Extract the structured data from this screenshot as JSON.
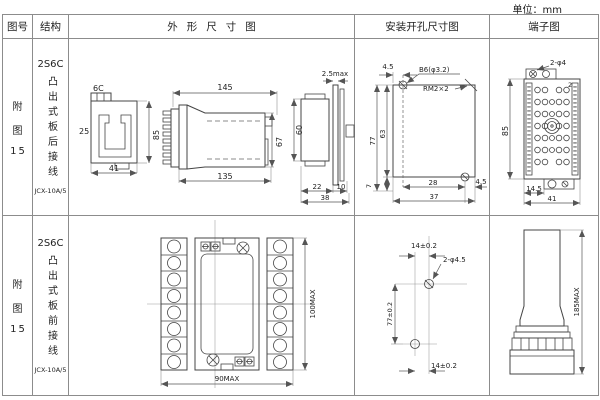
{
  "unit_label": "单位：mm",
  "colors": {
    "line": "#444444",
    "grid": "#8c8c8c",
    "text": "#222222",
    "background": "#ffffff"
  },
  "table": {
    "headers": {
      "fig_no": "图号",
      "structure": "结构",
      "outline": "外形尺寸图",
      "mounting": "安装开孔尺寸图",
      "terminal": "端子图"
    },
    "rows": [
      {
        "fig_no": {
          "l1": "附",
          "l2": "图",
          "l3": "15"
        },
        "structure": {
          "model": "2S6C",
          "desc": "凸出式板后接线",
          "type": "JCX-10A/5"
        },
        "outline": {
          "profile": {
            "top": "6C",
            "left": "25",
            "right": "85",
            "bottom": "41"
          },
          "side": {
            "top": "145",
            "bottom": "135",
            "right": "67"
          },
          "panel": {
            "top": "2.5max",
            "left": "60",
            "b1": "22",
            "b2": "10",
            "b3": "38"
          }
        },
        "mounting": {
          "top": "4.5",
          "hole_label": "B6(φ3.2)",
          "thread_label": "RM2×2",
          "left_outer": "77",
          "left_inner": "63",
          "bottom_left": "7",
          "bottom_inner": "28",
          "bottom_right": "4.5",
          "bottom_outer": "37"
        },
        "terminal": {
          "hole_label": "2-φ4",
          "corner": "2",
          "left": "85",
          "b1": "14.5",
          "b2": "41"
        }
      },
      {
        "fig_no": {
          "l1": "附",
          "l2": "图",
          "l3": "15"
        },
        "structure": {
          "model": "2S6C",
          "desc": "凸出式板前接线",
          "type": "JCX-10A/5"
        },
        "outline": {
          "bottom": "90MAX",
          "right": "100MAX"
        },
        "mounting": {
          "top": "14±0.2",
          "hole_label": "2-φ4.5",
          "left": "77±0.2",
          "bottom": "14±0.2"
        },
        "terminal": {
          "right": "185MAX"
        }
      }
    ]
  }
}
